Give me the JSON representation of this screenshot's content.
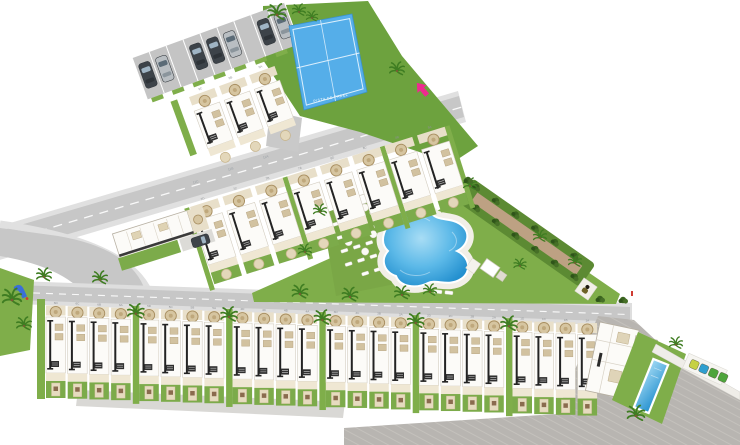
{
  "plan": {
    "padel_label": "PISTA DE PADEL",
    "road_labels": [
      "11A",
      "11B",
      "11C"
    ],
    "top_cluster_units": [
      "9C",
      "9B",
      "9A"
    ],
    "middle_row_units": [
      "7D",
      "7C",
      "7B",
      "7A",
      "8D",
      "8C",
      "8B",
      "8A"
    ],
    "bottom_row_units": [
      "6D",
      "6C",
      "6B",
      "6A",
      "5D",
      "5C",
      "5B",
      "5A",
      "4D",
      "4C",
      "4B",
      "4A",
      "3D",
      "3C",
      "3B",
      "3A",
      "2D",
      "2C",
      "2B",
      "2A",
      "1D",
      "1C",
      "1B",
      "1A"
    ],
    "parking_slots": [
      "dark",
      "silver",
      null,
      "dark",
      "dark",
      "silver",
      null,
      "dark",
      "silver"
    ],
    "counts": {
      "parked_cars": 7,
      "sun_loungers": 20,
      "parasols": 5,
      "recycling_bins": 4,
      "townhouses_bottom": 24,
      "townhouses_middle": 8,
      "townhouses_top": 3
    },
    "icons": {
      "entrance_arrow": "entrance-arrow-icon",
      "security_guard": "guard-icon",
      "playground_slide": "slide-icon",
      "palm_tree": "palm-tree-icon",
      "recycling_bins": "recycling-bin-icon"
    },
    "colors": {
      "grass": "#7fae4a",
      "grass_dark": "#6da23e",
      "hedge": "#3a641f",
      "road": "#c7c7c7",
      "sidewalk": "#e0e0e0",
      "driveway": "#b8b5b1",
      "roof_white": "#fcfbf8",
      "terrace_tan": "#e8dfc9",
      "medallion": "#d6c5a0",
      "ridge": "#232323",
      "court_blue": "#55aee9",
      "pool_light": "#a8ddf5",
      "pool_blue": "#2e96d5",
      "accent_pink": "#ee2a90",
      "slide_blue": "#3a6fd8",
      "car_dark": "#3d4349",
      "car_silver": "#b9bec2",
      "petanque_path": "#bda183",
      "bin_yellow": "#c6d143",
      "bin_blue": "#2f9fd0",
      "bin_green": "#4ea53c"
    }
  }
}
